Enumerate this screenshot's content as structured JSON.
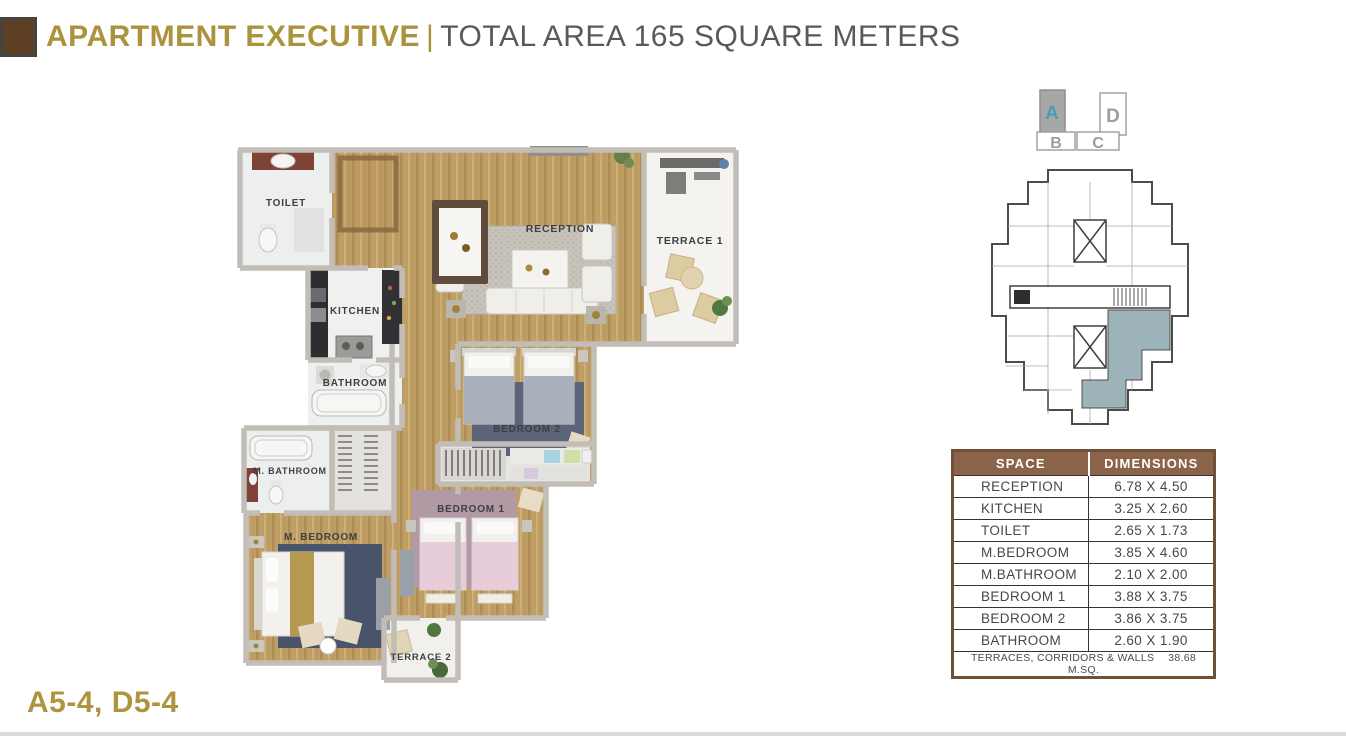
{
  "header": {
    "title": "APARTMENT EXECUTIVE",
    "separator": "|",
    "subtitle": "TOTAL AREA 165 SQUARE METERS"
  },
  "plan_code": "A5-4, D5-4",
  "floor_plan": {
    "labels": {
      "toilet": "TOILET",
      "kitchen": "KITCHEN",
      "bathroom": "BATHROOM",
      "reception": "RECEPTION",
      "terrace1": "TERRACE 1",
      "bedroom2": "BEDROOM 2",
      "m_bathroom": "M. BATHROOM",
      "m_bedroom": "M. BEDROOM",
      "bedroom1": "BEDROOM 1",
      "terrace2": "TERRACE 2"
    }
  },
  "unit_key": {
    "units": [
      {
        "label": "A",
        "highlighted": true
      },
      {
        "label": "B",
        "highlighted": false
      },
      {
        "label": "C",
        "highlighted": false
      },
      {
        "label": "D",
        "highlighted": false
      }
    ]
  },
  "dimensions_table": {
    "headers": [
      "SPACE",
      "DIMENSIONS"
    ],
    "rows": [
      {
        "space": "RECEPTION",
        "dimensions": "6.78 X 4.50"
      },
      {
        "space": "KITCHEN",
        "dimensions": "3.25 X 2.60"
      },
      {
        "space": "TOILET",
        "dimensions": "2.65 X 1.73"
      },
      {
        "space": "M.BEDROOM",
        "dimensions": "3.85 X 4.60"
      },
      {
        "space": "M.BATHROOM",
        "dimensions": "2.10 X 2.00"
      },
      {
        "space": "BEDROOM 1",
        "dimensions": "3.88 X 3.75"
      },
      {
        "space": "BEDROOM 2",
        "dimensions": "3.86 X 3.75"
      },
      {
        "space": "BATHROOM",
        "dimensions": "2.60 X 1.90"
      }
    ],
    "footer_label": "TERRACES, CORRIDORS & WALLS",
    "footer_value": "38.68 M.SQ."
  },
  "colors": {
    "accent_gold": "#ab923d",
    "subtitle_gray": "#58595c",
    "table_brown": "#8a6348",
    "unit_letter_blue": "#4f9ab8",
    "plate_highlight": "#9cb3b9",
    "wood_floor": "#bf9f66"
  }
}
